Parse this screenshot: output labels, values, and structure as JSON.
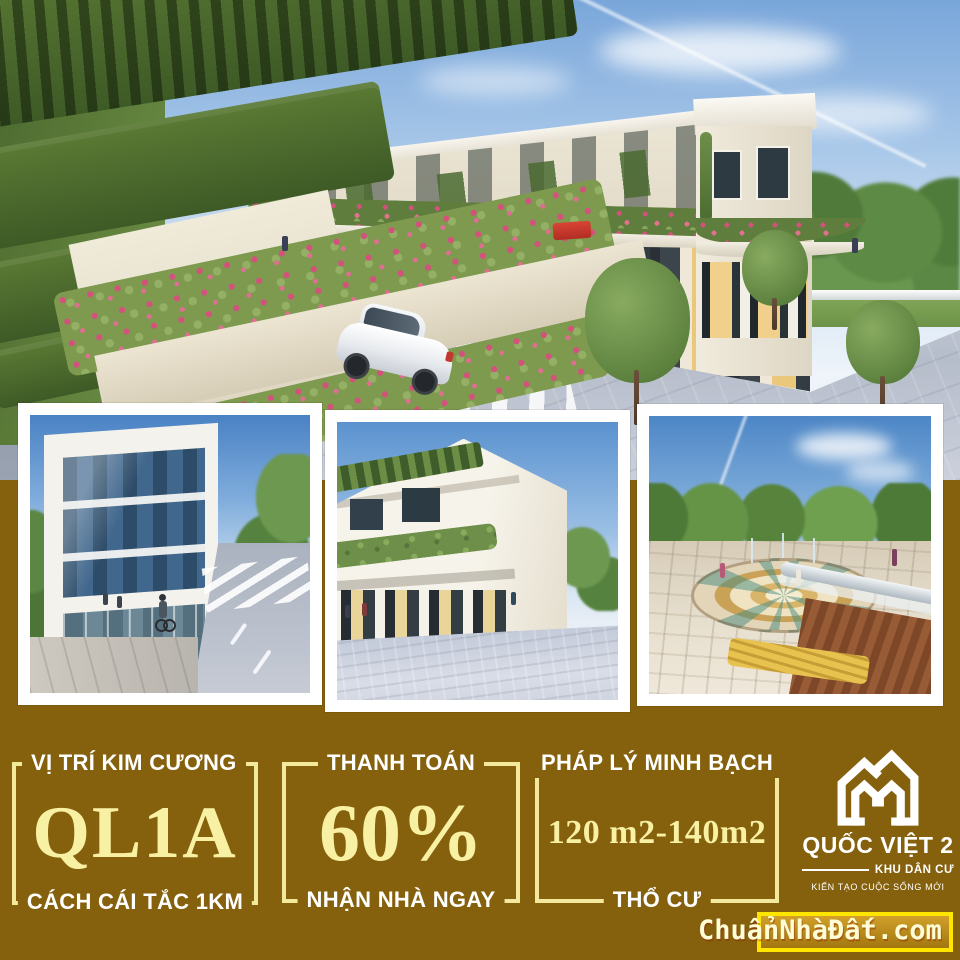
{
  "colors": {
    "panel_brown": "#85610d",
    "pale_yellow_value": "#f8f1a3",
    "bracket_yellow": "#f2e99c",
    "highlight_yellow": "#ffe600",
    "label_white": "#ffffff"
  },
  "photos": {
    "hero": {
      "alt": "row-houses street render"
    },
    "p1": {
      "alt": "glass office building street render"
    },
    "p2": {
      "alt": "corner shophouse render"
    },
    "p3": {
      "alt": "plaza fountain park render"
    }
  },
  "stats": [
    {
      "top": "VỊ TRÍ KIM CƯƠNG",
      "value": "QL1A",
      "bottom": "CÁCH CÁI TẮC 1KM"
    },
    {
      "top": "THANH TOÁN",
      "value": "60%",
      "bottom": "NHẬN NHÀ NGAY"
    },
    {
      "top": "PHÁP LÝ MINH BẠCH",
      "value": "120 m2-140m2",
      "bottom": "THỔ CƯ"
    }
  ],
  "logo": {
    "name": "QUỐC VIỆT 2",
    "subtitle": "KHU DÂN CƯ",
    "tagline": "KIẾN TẠO CUỘC SỐNG MỚI"
  },
  "watermark": {
    "text": "ChuẩnNhàĐất.com"
  }
}
